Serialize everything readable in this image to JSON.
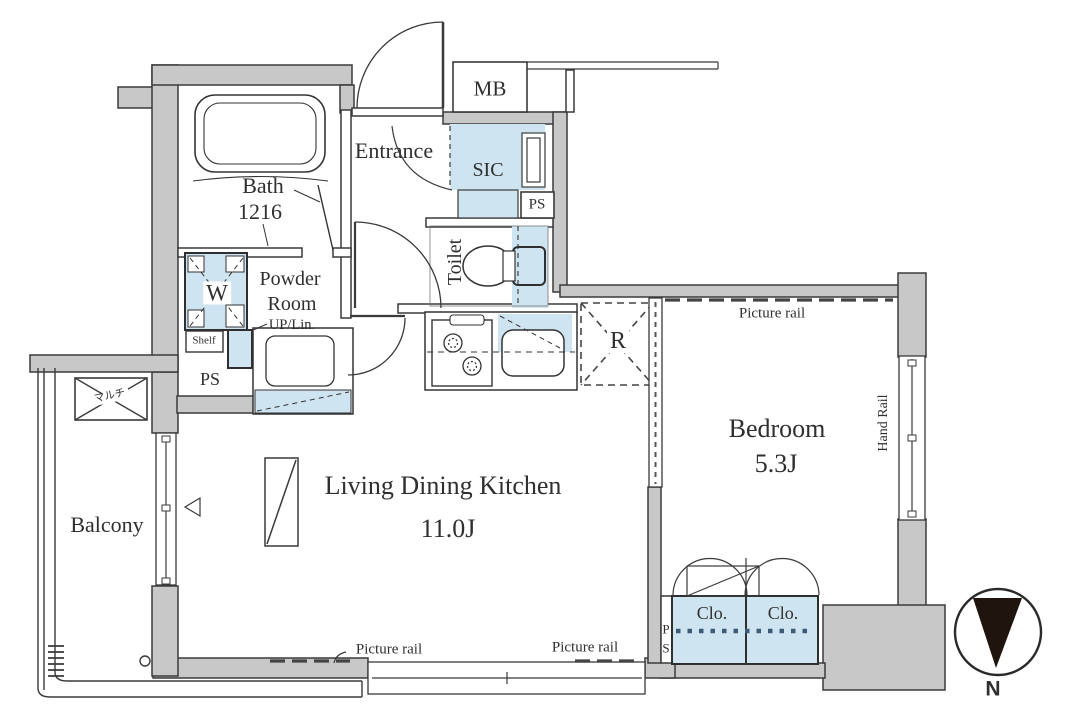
{
  "colors": {
    "wall_gray": "#c8c8c8",
    "line_dark": "#3a3a3a",
    "fixture_blue": "#cfe4f1",
    "closet_dot_blue": "#3d5b76",
    "text": "#2f2f2f"
  },
  "rooms": {
    "bath": {
      "name": "Bath",
      "size": "1216"
    },
    "entrance": {
      "name": "Entrance"
    },
    "sic": {
      "name": "SIC"
    },
    "toilet": {
      "name": "Toilet"
    },
    "powder_room": {
      "name_line1": "Powder",
      "name_line2": "Room",
      "up_lin": "UP/Lin."
    },
    "ldk": {
      "name": "Living Dining Kitchen",
      "area": "11.0J"
    },
    "bedroom": {
      "name": "Bedroom",
      "area": "5.3J"
    },
    "balcony": {
      "name": "Balcony"
    }
  },
  "fixtures": {
    "meter_box": "MB",
    "pipe_space_entrance": "PS",
    "pipe_space_powder": "PS",
    "pipe_space_bedroom_p": "P",
    "pipe_space_bedroom_s": "S",
    "washing_machine": "W",
    "shelf": "Shelf",
    "refrigerator": "R",
    "closet_left": "Clo.",
    "closet_right": "Clo.",
    "multimedia_outlet": "マルチ"
  },
  "annotations": {
    "picture_rail_bedroom": "Picture rail",
    "picture_rail_ldk_left": "Picture rail",
    "picture_rail_ldk_right": "Picture rail",
    "hand_rail": "Hand Rail"
  },
  "compass": {
    "north_label": "N"
  }
}
